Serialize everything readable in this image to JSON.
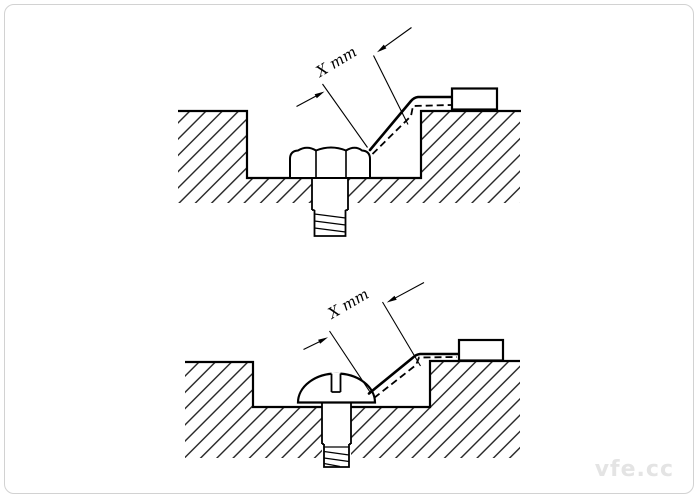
{
  "page": {
    "background_color": "#ffffff",
    "border_color": "#d2d2d2",
    "watermark": "vfe.cc"
  },
  "figures": {
    "upper": {
      "fastener": "recessed hex-head bolt",
      "dimension_label": "X mm"
    },
    "lower": {
      "fastener": "recessed slotted pan-head screw",
      "dimension_label": "X mm"
    }
  },
  "colors": {
    "line": "#000000",
    "hatch": "#1b1b1b",
    "watermark_text": "#e4e4e4"
  }
}
